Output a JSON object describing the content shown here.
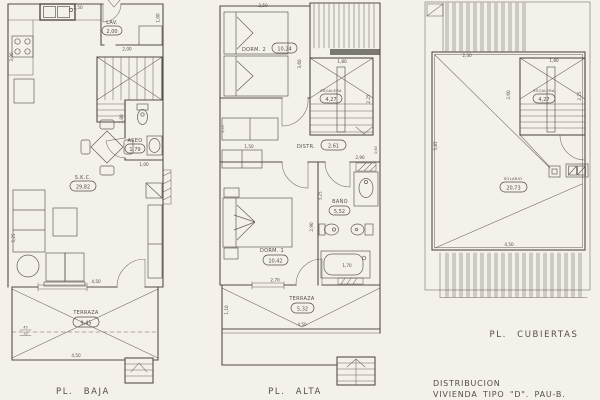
{
  "colors": {
    "paper": "#f4f1ea",
    "ink": "#534f48"
  },
  "footer": {
    "line1": "DISTRIBUCION",
    "line2": "VIVIENDA TIPO \"D\". PAU-B."
  },
  "baja": {
    "label": "PL. BAJA",
    "rooms": {
      "lav": {
        "name": "LAV.",
        "area": "2,00"
      },
      "aseo": {
        "name": "ASEO",
        "area": "1,79"
      },
      "skc": {
        "name": "S.K.C.",
        "area": "29,82"
      },
      "terraza": {
        "name": "TERRAZA",
        "area": "9,45"
      }
    },
    "dims": {
      "kitchen_top": "2,50",
      "kitchen_left": "3,00",
      "lav_width": "2,00",
      "lav_height": "1,00",
      "aseo_height": "1,80",
      "aseo_width": "1,00",
      "salon_left": "5,25",
      "salon_width": "4,50",
      "terraza_width": "4,50",
      "level_upper": "45",
      "level_lower": "10"
    }
  },
  "alta": {
    "label": "PL. ALTA",
    "rooms": {
      "dorm2": {
        "name": "DORM. 2",
        "area": "10,24"
      },
      "escalera": {
        "name": "ESCALERA",
        "area": "4,27"
      },
      "distr": {
        "name": "DISTR.",
        "area": "2,61"
      },
      "bano": {
        "name": "BAÑO",
        "area": "5,52"
      },
      "dorm1": {
        "name": "DORM. 1",
        "area": "10,42"
      },
      "terraza": {
        "name": "TERRAZA",
        "area": "5,32"
      }
    },
    "dims": {
      "dorm2_top": "2,50",
      "dorm2_right": "3,60",
      "stairs_top": "1,80",
      "stairs_right": "2,25",
      "closet_left": "0,55",
      "closet": "1,50",
      "hall_right": "0,60",
      "distr_width": "2,90",
      "bano_left": "3,25",
      "dorm1_right": "2,90",
      "dorm1_width": "2,70",
      "bath_length": "1,70",
      "terraza_left": "1,10",
      "terraza_width": "4,50"
    }
  },
  "cubiertas": {
    "label": "PL. CUBIERTAS",
    "rooms": {
      "escalera": {
        "name": "ESCALERA",
        "area": "4,27"
      },
      "solario": {
        "name": "SOLARIO",
        "area": "20,73"
      }
    },
    "dims": {
      "roof_top": "2,30",
      "stairs_top": "1,80",
      "roof_mid": "2,60",
      "roof_left": "5,85",
      "stairs_right": "2,25",
      "solario_width": "4,50"
    }
  }
}
